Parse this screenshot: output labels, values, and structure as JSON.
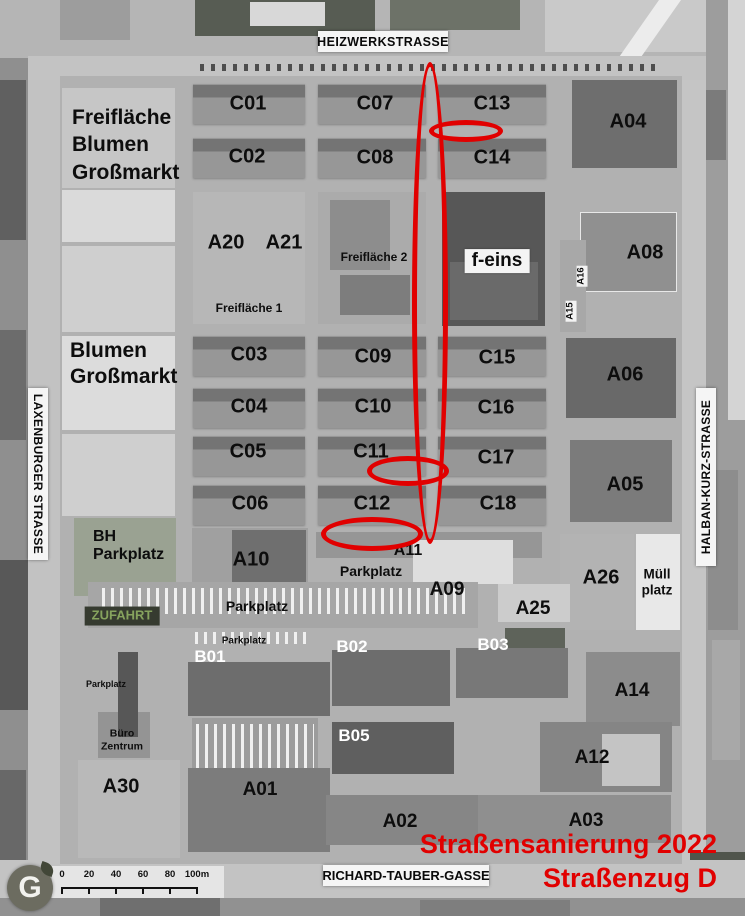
{
  "annotation": {
    "line1": "Straßensanierung 2022",
    "line2": "Straßenzug D",
    "color": "#e10000"
  },
  "streets": {
    "top": "HEIZWERKSTRASSE",
    "left": "LAXENBURGER STRASSE",
    "right": "HALBAN-KURZ-STRASSE",
    "bottom": "RICHARD-TAUBER-GASSE"
  },
  "scalebar": {
    "ticks": [
      "0",
      "20",
      "40",
      "60",
      "80",
      "100m"
    ]
  },
  "logo": {
    "letter": "G"
  },
  "map": {
    "labels": [
      {
        "id": "label-freiflaeche-blumen-grossmarkt",
        "text": "Freifläche\nBlumen\nGroßmarkt",
        "x": 72,
        "y": 104,
        "fs": 21,
        "anchor": "left",
        "lh": 1.3
      },
      {
        "id": "label-c01",
        "text": "C01",
        "x": 248,
        "y": 104,
        "fs": 20
      },
      {
        "id": "label-c07",
        "text": "C07",
        "x": 375,
        "y": 104,
        "fs": 20
      },
      {
        "id": "label-c13",
        "text": "C13",
        "x": 492,
        "y": 104,
        "fs": 20
      },
      {
        "id": "label-a04",
        "text": "A04",
        "x": 628,
        "y": 122,
        "fs": 20
      },
      {
        "id": "label-c02",
        "text": "C02",
        "x": 247,
        "y": 157,
        "fs": 20
      },
      {
        "id": "label-c08",
        "text": "C08",
        "x": 375,
        "y": 158,
        "fs": 20
      },
      {
        "id": "label-c14",
        "text": "C14",
        "x": 492,
        "y": 158,
        "fs": 20
      },
      {
        "id": "label-a20",
        "text": "A20",
        "x": 226,
        "y": 243,
        "fs": 20
      },
      {
        "id": "label-a21",
        "text": "A21",
        "x": 284,
        "y": 243,
        "fs": 20
      },
      {
        "id": "label-freiflaeche-2",
        "text": "Freifläche 2",
        "x": 374,
        "y": 258,
        "fs": 12
      },
      {
        "id": "label-f-eins",
        "text": "f-eins",
        "x": 497,
        "y": 261,
        "fs": 19,
        "box": "white"
      },
      {
        "id": "label-a08",
        "text": "A08",
        "x": 645,
        "y": 253,
        "fs": 20
      },
      {
        "id": "label-a16",
        "text": "A16",
        "x": 582,
        "y": 276,
        "fs": 9.5,
        "rot": -90,
        "box": "tag"
      },
      {
        "id": "label-a15",
        "text": "A15",
        "x": 571,
        "y": 311,
        "fs": 9.5,
        "rot": -90,
        "box": "tag"
      },
      {
        "id": "label-freiflaeche-1",
        "text": "Freifläche 1",
        "x": 249,
        "y": 309,
        "fs": 12
      },
      {
        "id": "label-blumen-grossmarkt",
        "text": "Blumen\nGroßmarkt",
        "x": 70,
        "y": 338,
        "fs": 21,
        "anchor": "left",
        "lh": 1.25
      },
      {
        "id": "label-c03",
        "text": "C03",
        "x": 249,
        "y": 355,
        "fs": 20
      },
      {
        "id": "label-c09",
        "text": "C09",
        "x": 373,
        "y": 357,
        "fs": 20
      },
      {
        "id": "label-c15",
        "text": "C15",
        "x": 497,
        "y": 358,
        "fs": 20
      },
      {
        "id": "label-a06",
        "text": "A06",
        "x": 625,
        "y": 375,
        "fs": 20
      },
      {
        "id": "label-c04",
        "text": "C04",
        "x": 249,
        "y": 407,
        "fs": 20
      },
      {
        "id": "label-c10",
        "text": "C10",
        "x": 373,
        "y": 407,
        "fs": 20
      },
      {
        "id": "label-c16",
        "text": "C16",
        "x": 496,
        "y": 408,
        "fs": 20
      },
      {
        "id": "label-c05",
        "text": "C05",
        "x": 248,
        "y": 452,
        "fs": 20
      },
      {
        "id": "label-c11",
        "text": "C11",
        "x": 371,
        "y": 452,
        "fs": 20
      },
      {
        "id": "label-c17",
        "text": "C17",
        "x": 496,
        "y": 458,
        "fs": 20
      },
      {
        "id": "label-a05",
        "text": "A05",
        "x": 625,
        "y": 485,
        "fs": 20
      },
      {
        "id": "label-c06",
        "text": "C06",
        "x": 250,
        "y": 504,
        "fs": 20
      },
      {
        "id": "label-c12",
        "text": "C12",
        "x": 372,
        "y": 504,
        "fs": 20
      },
      {
        "id": "label-c18",
        "text": "C18",
        "x": 498,
        "y": 504,
        "fs": 20
      },
      {
        "id": "label-bh-parkplatz",
        "text": "BH\nParkplatz",
        "x": 93,
        "y": 528,
        "fs": 16,
        "anchor": "left",
        "lh": 1.1
      },
      {
        "id": "label-a10",
        "text": "A10",
        "x": 251,
        "y": 560,
        "fs": 20
      },
      {
        "id": "label-a11",
        "text": "A11",
        "x": 408,
        "y": 551,
        "fs": 16
      },
      {
        "id": "label-parkplatz-mitte",
        "text": "Parkplatz",
        "x": 371,
        "y": 571,
        "fs": 14
      },
      {
        "id": "label-a26",
        "text": "A26",
        "x": 601,
        "y": 578,
        "fs": 20
      },
      {
        "id": "label-muell-platz",
        "text": "Müll\nplatz",
        "x": 657,
        "y": 582,
        "fs": 13.5,
        "lh": 1.15
      },
      {
        "id": "label-a09",
        "text": "A09",
        "x": 447,
        "y": 590,
        "fs": 19
      },
      {
        "id": "label-parkplatz-row",
        "text": "Parkplatz",
        "x": 257,
        "y": 606,
        "fs": 14
      },
      {
        "id": "label-a25",
        "text": "A25",
        "x": 533,
        "y": 609,
        "fs": 19
      },
      {
        "id": "label-zufahrt",
        "text": "ZUFAHRT",
        "x": 122,
        "y": 616,
        "fs": 13,
        "box": "dark",
        "color": "#86a35e"
      },
      {
        "id": "label-parkplatz-small",
        "text": "Parkplatz",
        "x": 244,
        "y": 641,
        "fs": 10
      },
      {
        "id": "label-b03",
        "text": "B03",
        "x": 493,
        "y": 645,
        "fs": 17,
        "color": "#ffffff"
      },
      {
        "id": "label-b02",
        "text": "B02",
        "x": 352,
        "y": 647,
        "fs": 17,
        "color": "#ffffff"
      },
      {
        "id": "label-b01",
        "text": "B01",
        "x": 210,
        "y": 657,
        "fs": 17,
        "color": "#ffffff"
      },
      {
        "id": "label-parkplatz-west",
        "text": "Parkplatz",
        "x": 106,
        "y": 684,
        "fs": 9
      },
      {
        "id": "label-a14",
        "text": "A14",
        "x": 632,
        "y": 691,
        "fs": 19
      },
      {
        "id": "label-b05",
        "text": "B05",
        "x": 354,
        "y": 736,
        "fs": 17,
        "color": "#ffffff"
      },
      {
        "id": "label-buero-zentrum",
        "text": "Büro\nZentrum",
        "x": 122,
        "y": 740,
        "fs": 10.5,
        "lh": 1.2
      },
      {
        "id": "label-a12",
        "text": "A12",
        "x": 592,
        "y": 758,
        "fs": 19
      },
      {
        "id": "label-a30",
        "text": "A30",
        "x": 121,
        "y": 787,
        "fs": 20
      },
      {
        "id": "label-a01",
        "text": "A01",
        "x": 260,
        "y": 790,
        "fs": 19
      },
      {
        "id": "label-a03",
        "text": "A03",
        "x": 586,
        "y": 821,
        "fs": 19
      },
      {
        "id": "label-a02",
        "text": "A02",
        "x": 400,
        "y": 822,
        "fs": 19
      }
    ]
  }
}
